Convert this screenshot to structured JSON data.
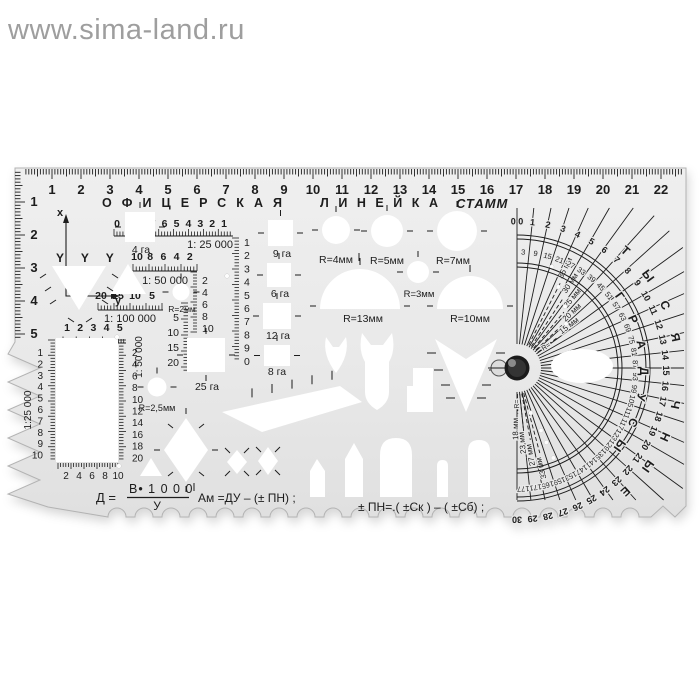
{
  "watermark": {
    "text": "www.sima-land.ru"
  },
  "ruler": {
    "title": "ОФИЦЕРСКАЯ ЛИНЕЙКА",
    "brand": "СТАММ",
    "top_numbers": [
      "1",
      "2",
      "3",
      "4",
      "5",
      "6",
      "7",
      "8",
      "9",
      "10",
      "11",
      "12",
      "13",
      "14",
      "15",
      "16",
      "17",
      "18",
      "19",
      "20",
      "21",
      "22"
    ],
    "side_numbers": [
      "1",
      "2",
      "3",
      "4",
      "5"
    ],
    "axes": {
      "x": "x",
      "y": "y"
    },
    "trees": "Y Y Y",
    "scales": [
      {
        "digits": [
          "0",
          "9",
          "8",
          "7",
          "6",
          "5",
          "4",
          "3",
          "2",
          "1"
        ],
        "label": "1: 25 000"
      },
      {
        "digits": [
          "10",
          "8",
          "6",
          "4",
          "2"
        ],
        "label": "1: 50 000"
      },
      {
        "digits": [
          "20",
          "15",
          "10",
          "5"
        ],
        "label": "1: 100 000"
      },
      {
        "digits": [
          "1",
          "2",
          "3",
          "4",
          "5"
        ],
        "label": ""
      }
    ],
    "rect_gauge": {
      "left_label": "1:25 000",
      "right_label": "1: 50 000",
      "left_digits": [
        "1",
        "2",
        "3",
        "4",
        "5",
        "6",
        "7",
        "8",
        "9",
        "10"
      ],
      "right_digits": [
        "2",
        "4",
        "6",
        "8",
        "10",
        "12",
        "14",
        "16",
        "18",
        "20"
      ],
      "bottom_digits": [
        "2",
        "4",
        "6",
        "8",
        "10"
      ]
    },
    "columns": [
      {
        "digits": [
          "1",
          "2",
          "3",
          "4",
          "5",
          "6",
          "7",
          "8",
          "9",
          "0"
        ]
      },
      {
        "digits": [
          "2",
          "4",
          "6",
          "8",
          "10"
        ]
      },
      {
        "digits": [
          "5",
          "10",
          "15",
          "20"
        ]
      }
    ],
    "squares": [
      {
        "label": "4 га"
      },
      {
        "label": "9 га"
      },
      {
        "label": "6 га"
      },
      {
        "label": "12 га"
      },
      {
        "label": "8 га"
      },
      {
        "label": "25 га"
      }
    ],
    "circles": [
      {
        "label": "R=2мм"
      },
      {
        "label": "R=2,5мм"
      },
      {
        "label": "R=4мм"
      },
      {
        "label": "R=5мм"
      },
      {
        "label": "R=7мм"
      },
      {
        "label": "R=3мм"
      }
    ],
    "domes": [
      {
        "label": "R=13мм"
      },
      {
        "label": "R=10мм"
      }
    ],
    "formulas": {
      "lhs": "Д =",
      "numerator": "В• 1 0 0 0",
      "denominator": "У",
      "f2": "Ам =ДУ – (± ПН) ;",
      "f3": "± ПН=.( ±Ск ) – ( ±Сб) ;"
    },
    "protractor": {
      "mils": [
        "0 0",
        "1",
        "2",
        "3",
        "4",
        "5",
        "6",
        "7",
        "8",
        "9",
        "10",
        "11",
        "12",
        "13",
        "14",
        "15",
        "16",
        "17",
        "18",
        "19",
        "20",
        "21",
        "22",
        "23",
        "24",
        "25",
        "26",
        "27",
        "28",
        "29",
        "30"
      ],
      "degrees": [
        "3",
        "9",
        "15",
        "21",
        "27",
        "33",
        "39",
        "45",
        "51",
        "57",
        "63",
        "69",
        "75",
        "81",
        "87",
        "93",
        "99",
        "105",
        "111",
        "117",
        "123",
        "129",
        "135",
        "141",
        "147",
        "153",
        "159",
        "165",
        "171",
        "177"
      ],
      "word_degrees": "ГРАДУСЫ",
      "word_mils": "ТЫСЯЧНЫЕ",
      "upper_marks": [
        "35 мм",
        "30 мм",
        "25 мм",
        "20 мм",
        "15 мм"
      ],
      "lower_marks": [
        "18 мм",
        "23 мм",
        "27 мм",
        "33 мм"
      ],
      "r_prefix": "R="
    }
  }
}
